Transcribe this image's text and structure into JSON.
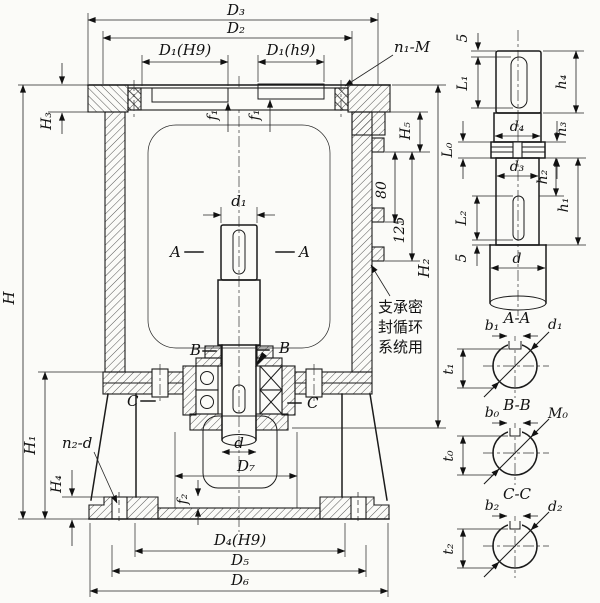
{
  "drawing": {
    "top_dims": {
      "D3": "D₃",
      "D2": "D₂",
      "D1H9": "D₁(H9)",
      "D1h9": "D₁(h9)",
      "n1M": "n₁-M",
      "f1": "f₁",
      "H3": "H₃"
    },
    "left_dims": {
      "H": "H",
      "H1": "H₁",
      "H4": "H₄",
      "n2d": "n₂-d"
    },
    "right_dims": {
      "H5": "H₅",
      "dim80": "80",
      "dim125": "125",
      "H2": "H₂"
    },
    "note_lines": [
      "支承密",
      "封循环",
      "系统用"
    ],
    "center": {
      "d1": "d₁",
      "A": "A",
      "B": "B",
      "C": "C",
      "d": "d",
      "D7": "D₇",
      "f2": "f₂"
    },
    "bottom_dims": {
      "D4H9": "D₄(H9)",
      "D5": "D₅",
      "D6": "D₆"
    },
    "shaft": {
      "five": "5",
      "L1": "L₁",
      "h4": "h₄",
      "d4": "d₄",
      "L0": "L₀",
      "h3": "h₃",
      "d3": "d₃",
      "h2": "h₂",
      "h1": "h₁",
      "L2": "L₂",
      "d": "d"
    },
    "sections": {
      "AA": {
        "title": "A-A",
        "b": "b₁",
        "dia": "d₁",
        "t": "t₁"
      },
      "BB": {
        "title": "B-B",
        "b": "b₀",
        "dia": "M₀",
        "t": "t₀"
      },
      "CC": {
        "title": "C-C",
        "b": "b₂",
        "dia": "d₂",
        "t": "t₂"
      }
    }
  }
}
